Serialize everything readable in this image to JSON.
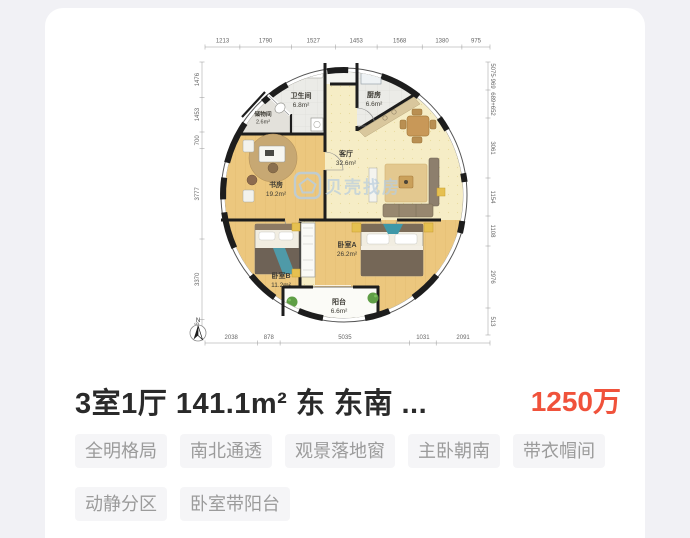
{
  "listing": {
    "title": "3室1厅 141.1m² 东 东南 ...",
    "price": "1250万",
    "tags": [
      "全明格局",
      "南北通透",
      "观景落地窗",
      "主卧朝南",
      "带衣帽间",
      "动静分区",
      "卧室带阳台"
    ]
  },
  "plan": {
    "compass": "N",
    "watermark": "贝壳找房",
    "rooms": {
      "storage": {
        "name": "储物间",
        "area": "2.6m²"
      },
      "bathroom": {
        "name": "卫生间",
        "area": "6.8m²"
      },
      "kitchen": {
        "name": "厨房",
        "area": "6.6m²"
      },
      "living": {
        "name": "客厅",
        "area": "32.6m²"
      },
      "study": {
        "name": "书房",
        "area": "19.2m²"
      },
      "bedroomA": {
        "name": "卧室A",
        "area": "26.2m²"
      },
      "bedroomB": {
        "name": "卧室B",
        "area": "11.2m²"
      },
      "balcony": {
        "name": "阳台",
        "area": "6.6m²"
      }
    },
    "dims": {
      "top": [
        "1213",
        "1790",
        "1527",
        "1453",
        "1568",
        "1380",
        "975"
      ],
      "bottom": [
        "2038",
        "878",
        "5035",
        "1031",
        "2091"
      ],
      "left": [
        "1476",
        "1453",
        "700",
        "3777",
        "3370",
        "646"
      ],
      "right": [
        "5075·969",
        "689+652",
        "3061",
        "1154",
        "1108",
        "2976",
        "513"
      ]
    }
  },
  "colors": {
    "price": "#f0523b",
    "tag_text": "#9b9b9b",
    "tag_background": "#f5f5f7",
    "watermark": "#b9cedf",
    "wood_floor": "#ecc77e",
    "living_floor": "#f6edc6",
    "wall": "#1d1d1d",
    "page_background": "#f1f1f5"
  }
}
